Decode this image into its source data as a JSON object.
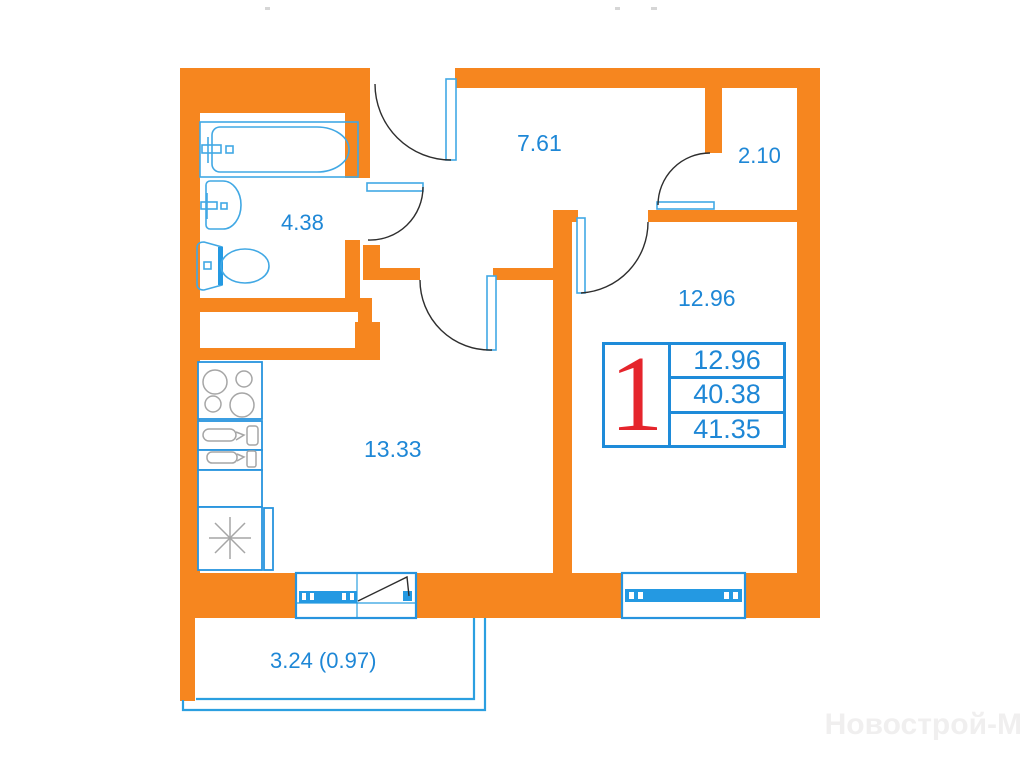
{
  "plan": {
    "room_labels": {
      "bathroom": "4.38",
      "hallway": "7.61",
      "wardrobe": "2.10",
      "living_room": "12.96",
      "kitchen_living": "13.33",
      "balcony": "3.24 (0.97)"
    },
    "info_table": {
      "apartment_number": "1",
      "rows": [
        "12.96",
        "40.38",
        "41.35"
      ]
    },
    "watermark": "Новострой-М",
    "colors": {
      "wall_orange": "#F6861F",
      "fixture_blue": "#41A8E4",
      "accent_blue": "#2499E2",
      "label_blue": "#1E87D6",
      "table_border_blue": "#1E8BD9",
      "apartment_number_red": "#E5252C",
      "appliance_gray": "#A6A6A6",
      "door_arc_dark": "#2e2e2e",
      "watermark_gray": "#F0EFEF"
    }
  }
}
